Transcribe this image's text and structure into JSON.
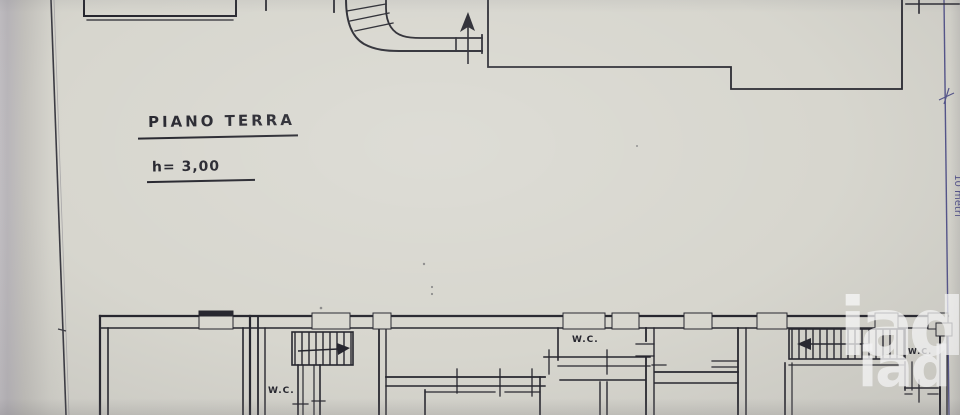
{
  "photo": {
    "description": "photograph of a hand-drafted architectural floor plan on paper"
  },
  "plan": {
    "title": "PIANO TERRA",
    "height_note": "h= 3,00",
    "scale_label": "10 metri",
    "wc_labels": [
      "W.C.",
      "W.C.",
      "W.C."
    ]
  },
  "watermark": {
    "brand_mark": "iad",
    "brand_text": "iad"
  },
  "colors": {
    "paper": "#d7d6ce",
    "ink": "#26262e",
    "dimension_blue": "#54548b",
    "photo_edge": "#b9b6ba",
    "watermark_white": "#ffffff"
  }
}
